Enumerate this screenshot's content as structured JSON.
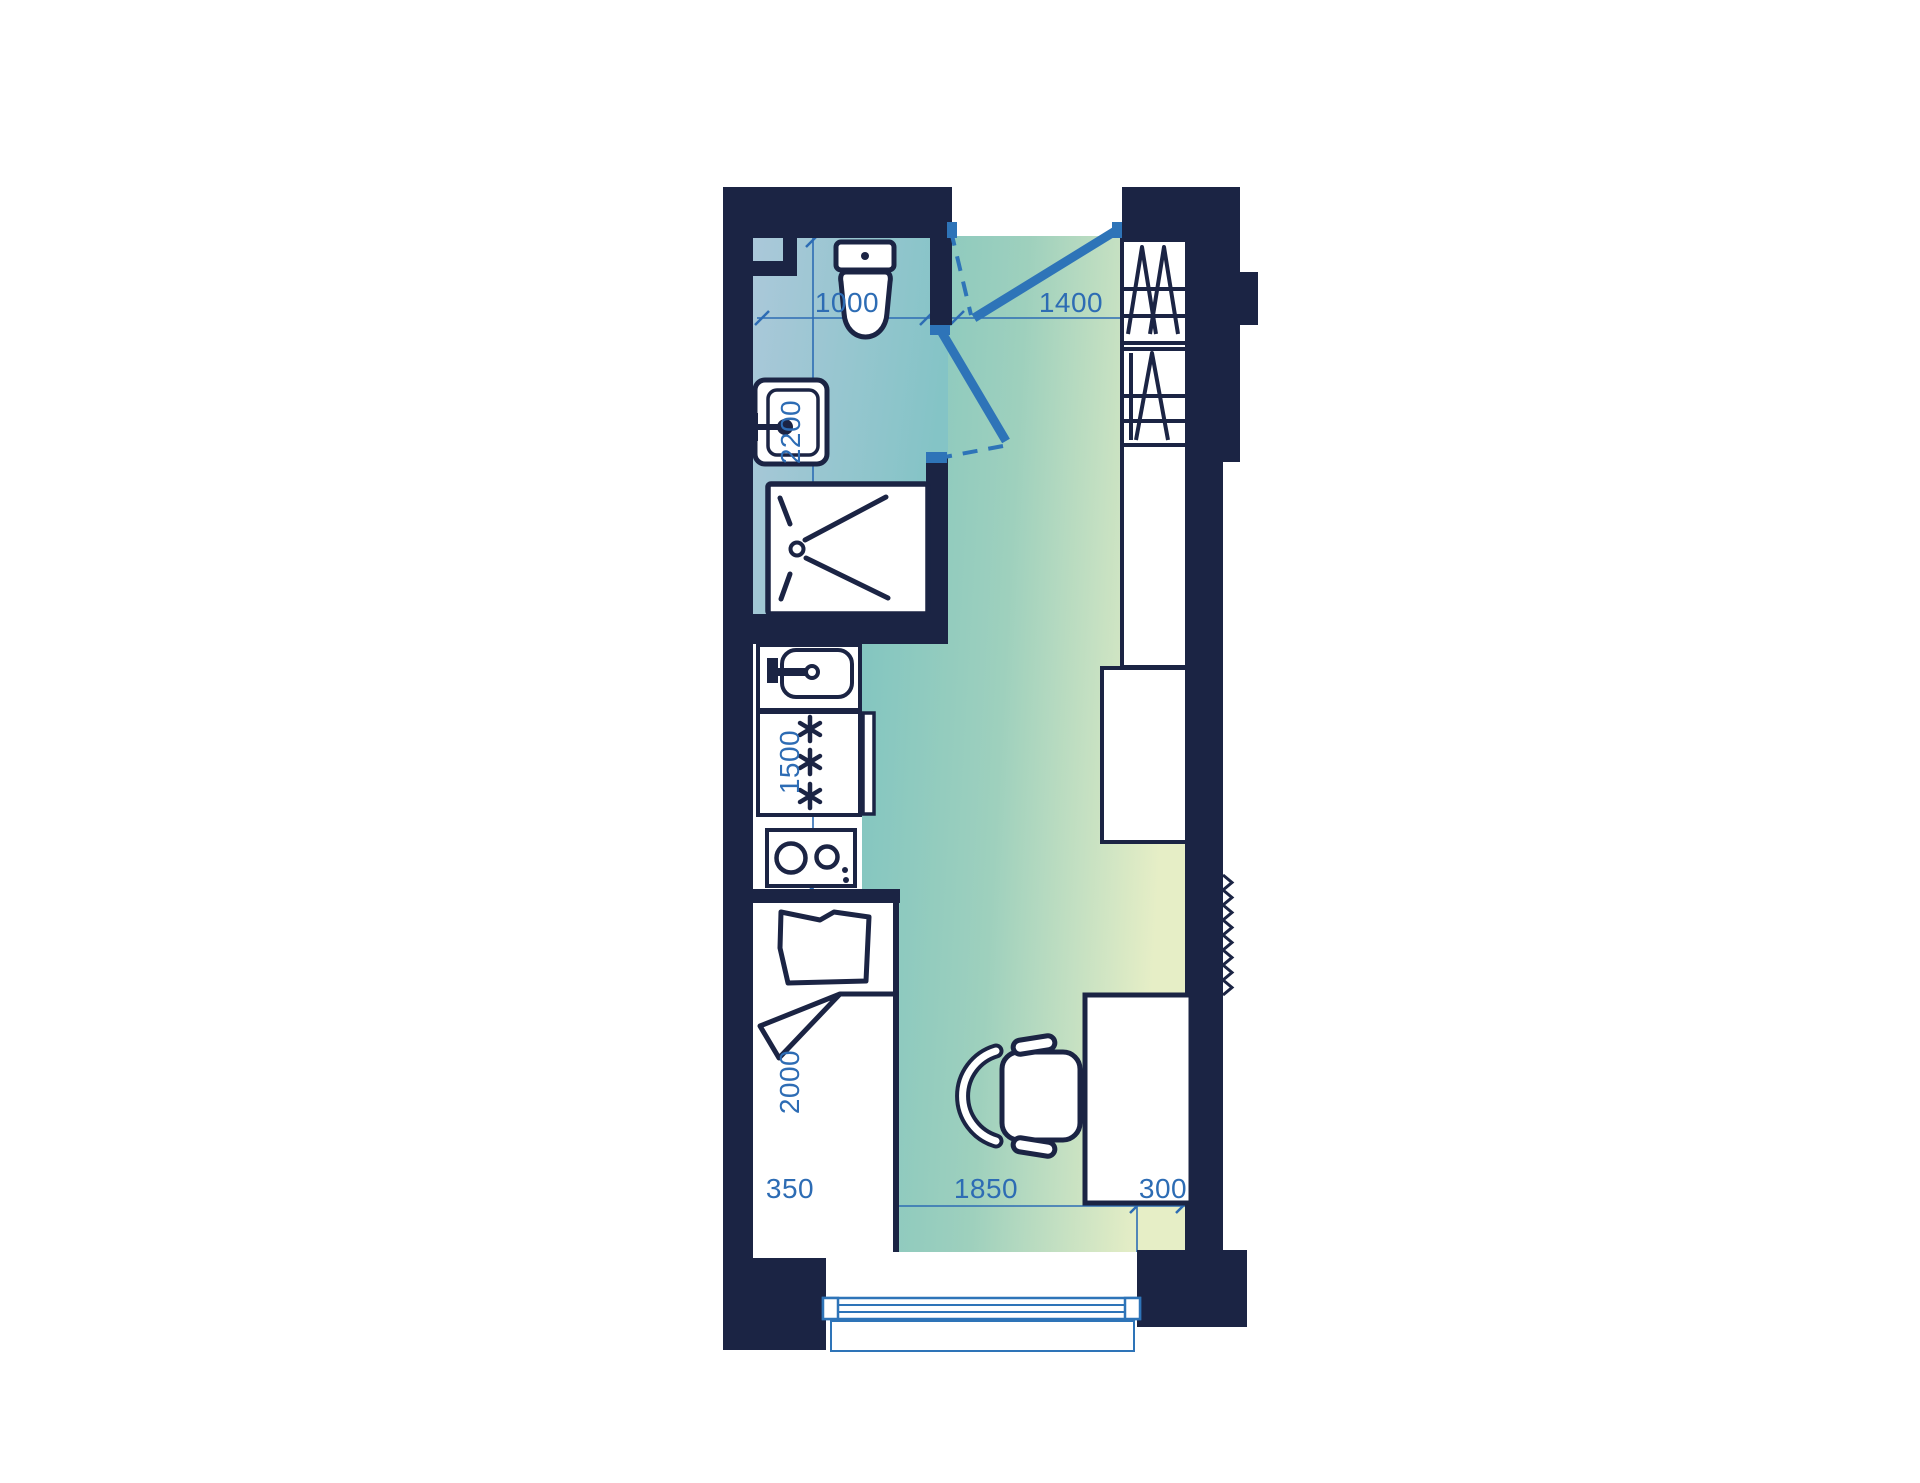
{
  "plan": {
    "title": "studio-apartment-floor-plan",
    "labels": {
      "w_bath": "1000",
      "w_entry": "1400",
      "d_bath": "2200",
      "d_kitchen": "1500",
      "d_bed": "2000",
      "b_left": "350",
      "b_center": "1850",
      "b_right": "300"
    },
    "colors": {
      "wall": "#1b2444",
      "door": "#2e74b8",
      "dim": "#2d6cb4",
      "bath_a": "#abc8da",
      "bath_b": "#84c4c6",
      "room_a": "#7fc4c1",
      "room_b": "#9ed0bd",
      "room_c": "#e6eec6"
    }
  }
}
